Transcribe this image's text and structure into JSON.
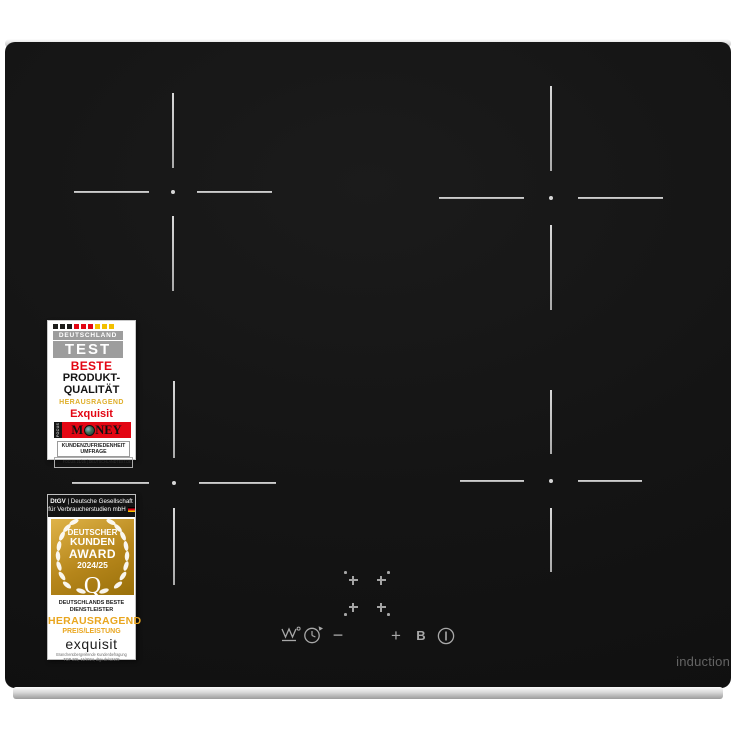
{
  "cooktop": {
    "brand_text": "induction",
    "colors": {
      "surface": "#141414",
      "zone_line": "#c4c4c4",
      "icon_gray": "#a8a8a8",
      "trim_silver": "#d8d8d8"
    },
    "zones": [
      {
        "name": "back-left",
        "cx": 173,
        "cy": 192,
        "arm": 75,
        "gap": 24
      },
      {
        "name": "back-right",
        "cx": 551,
        "cy": 198,
        "arm": 85,
        "gap": 27
      },
      {
        "name": "front-left",
        "cx": 174,
        "cy": 483,
        "arm": 77,
        "gap": 25
      },
      {
        "name": "front-right",
        "cx": 551,
        "cy": 481,
        "arm": 64,
        "gap": 27
      }
    ],
    "zone_selectors": [
      {
        "x": 353,
        "y": 580,
        "dot": "top-left"
      },
      {
        "x": 381,
        "y": 580,
        "dot": "top-right"
      },
      {
        "x": 353,
        "y": 607,
        "dot": "bottom-left"
      },
      {
        "x": 381,
        "y": 607,
        "dot": "bottom-right"
      }
    ],
    "controls": {
      "keep_warm_icon": "keep-warm",
      "timer_icon": "timer",
      "minus_label": "−",
      "plus_label": "+",
      "booster_label": "B",
      "power_icon": "power"
    }
  },
  "badges": {
    "deutschland_test": {
      "flag_colors": [
        "#1d1d1b",
        "#1d1d1b",
        "#1d1d1b",
        "#e30613",
        "#e30613",
        "#e30613",
        "#f3c000",
        "#f3c000",
        "#f3c000"
      ],
      "header_small": "DEUTSCHLAND",
      "header_big": "TEST",
      "award_level": "BESTE",
      "award_line1": "PRODUKT-",
      "award_line2": "QUALITÄT",
      "rating": "HERAUSRAGEND",
      "brand": "Exquisit",
      "money_vertical": "FOCUS",
      "money_m": "M",
      "money_ney": "NEY",
      "category_line1": "KUNDENZUFRIEDENHEIT",
      "category_line2": "UMFRAGE",
      "source": "FOCUS 21/25 | DEUTSCHLANDTEST.DE"
    },
    "kunden_award": {
      "header_org": "DtGV",
      "header_rest": " | Deutsche Gesellschaft",
      "header_line2": "für Verbraucherstudien mbH",
      "award_line1": "DEUTSCHER",
      "award_line2": "KUNDEN",
      "award_line3": "AWARD",
      "award_line4": "2024/25",
      "award_monogram": "Q",
      "sub_line1": "DEUTSCHLANDS BESTE",
      "sub_line2": "DIENSTLEISTER",
      "rating": "HERAUSRAGEND",
      "rating_category": "PREIS/LEISTUNG",
      "brand": "exquisit",
      "source_line1": "Branchenübergreifende Kundenbefragung",
      "source_line2": "TOP 205, 11/2024, dtgv.de/12109"
    }
  }
}
